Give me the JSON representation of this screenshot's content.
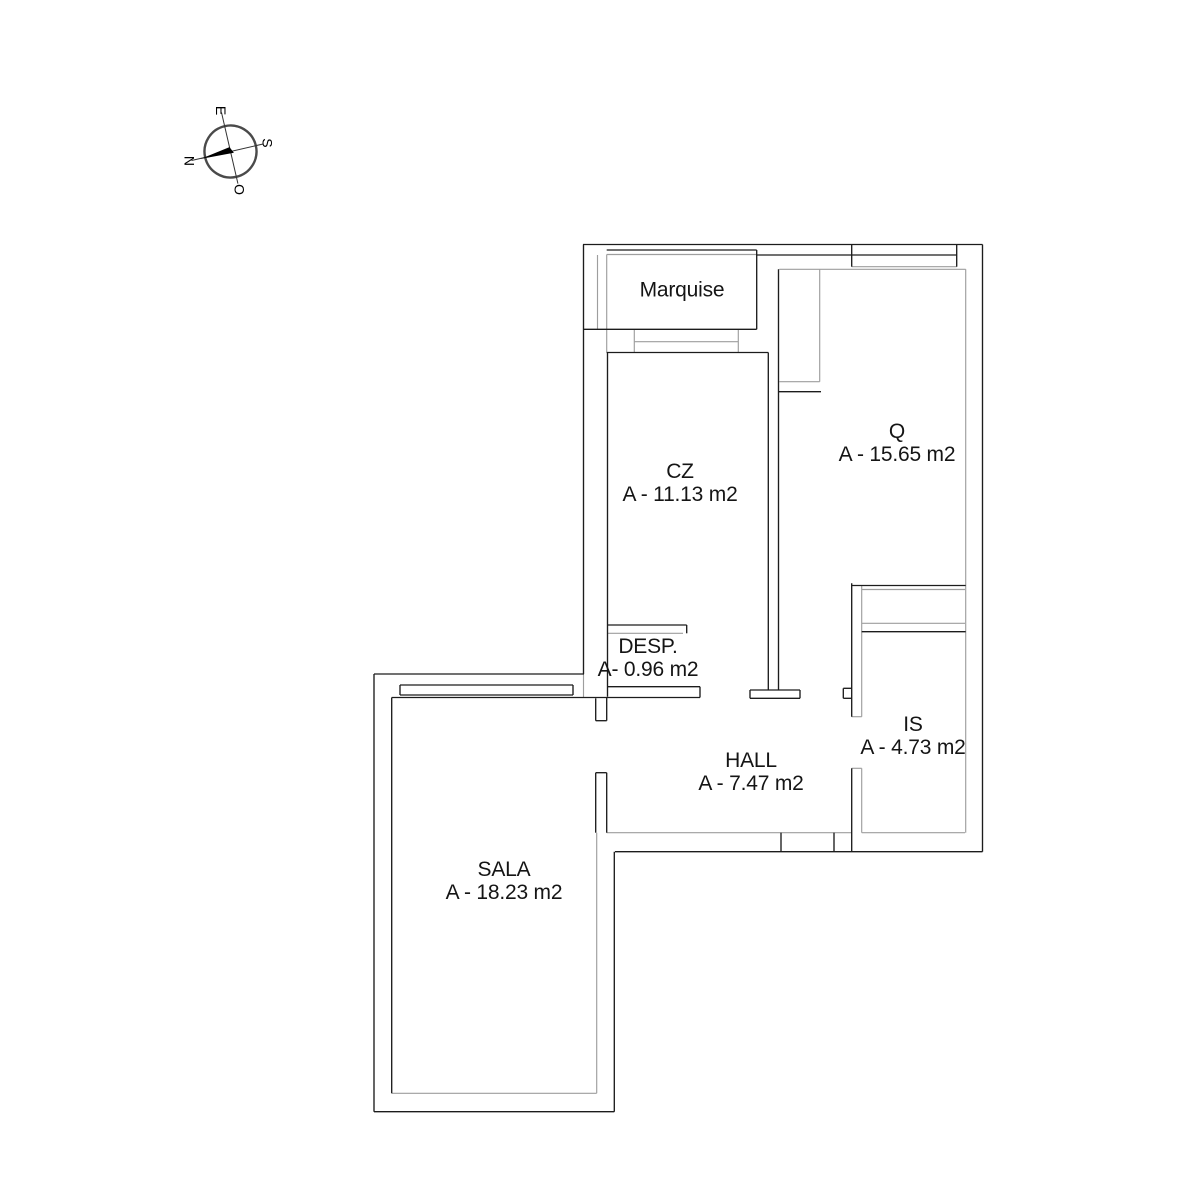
{
  "page": {
    "width": 1200,
    "height": 1200,
    "background": "#ffffff"
  },
  "colors": {
    "wall_dark": "#1c1c1c",
    "wall_light": "#9e9e9e",
    "text": "#151515",
    "compass_ring": "#4a4a4a",
    "compass_needle": "#000000"
  },
  "compass": {
    "center_x": 230.5,
    "center_y": 151.5,
    "radius": 26,
    "rotation_deg": -13,
    "letters": [
      {
        "text": "E",
        "dir": "up"
      },
      {
        "text": "S",
        "dir": "right"
      },
      {
        "text": "O",
        "dir": "down"
      },
      {
        "text": "N",
        "dir": "left"
      }
    ]
  },
  "rooms": [
    {
      "id": "marquise",
      "label": "Marquise",
      "area": "",
      "x": 682,
      "y": 290
    },
    {
      "id": "cz",
      "label": "CZ",
      "area": "A - 11.13 m2",
      "x": 680,
      "y": 483
    },
    {
      "id": "q",
      "label": "Q",
      "area": "A - 15.65 m2",
      "x": 897,
      "y": 443
    },
    {
      "id": "desp",
      "label": "DESP.",
      "area": "A- 0.96 m2",
      "x": 648,
      "y": 658
    },
    {
      "id": "is",
      "label": "IS",
      "area": "A - 4.73 m2",
      "x": 913,
      "y": 736
    },
    {
      "id": "hall",
      "label": "HALL",
      "area": "A - 7.47 m2",
      "x": 751,
      "y": 772
    },
    {
      "id": "sala",
      "label": "SALA",
      "area": "A - 18.23 m2",
      "x": 504,
      "y": 881
    }
  ],
  "walls": {
    "dark": [
      [
        583,
        244.5,
        982.5,
        244.5
      ],
      [
        982.5,
        244.5,
        982.5,
        851.7
      ],
      [
        615,
        851.7,
        982.5,
        851.7
      ],
      [
        583.5,
        244.5,
        583.5,
        674
      ],
      [
        606.7,
        250,
        756.7,
        250
      ],
      [
        756.7,
        250,
        756.7,
        329.3
      ],
      [
        583.5,
        329.3,
        756.7,
        329.3
      ],
      [
        756.7,
        255,
        851.7,
        255
      ],
      [
        851.7,
        244.5,
        851.7,
        266.7
      ],
      [
        956.7,
        244.5,
        956.7,
        266.7
      ],
      [
        851.7,
        255,
        956.7,
        255
      ],
      [
        768.3,
        352.5,
        768.3,
        690
      ],
      [
        778.5,
        269.3,
        778.5,
        690
      ],
      [
        750,
        690,
        800,
        690
      ],
      [
        750,
        698.3,
        800,
        698.3
      ],
      [
        750,
        690,
        750,
        698.3
      ],
      [
        800,
        690,
        800,
        698.3
      ],
      [
        606.7,
        352.5,
        768.3,
        352.5
      ],
      [
        607.5,
        352.5,
        607.5,
        696.7
      ],
      [
        608,
        625,
        686.7,
        625
      ],
      [
        686.7,
        625,
        686.7,
        633.3
      ],
      [
        608,
        686.7,
        700,
        686.7
      ],
      [
        391.7,
        697.5,
        700,
        697.5
      ],
      [
        700,
        686.7,
        700,
        697.5
      ],
      [
        778.5,
        391.7,
        821,
        391.7
      ],
      [
        851.7,
        585.5,
        965.7,
        585.5
      ],
      [
        851.7,
        583.3,
        851.7,
        716.7
      ],
      [
        861.7,
        631.7,
        965.7,
        631.7
      ],
      [
        843.3,
        688.3,
        851.7,
        688.3
      ],
      [
        843.3,
        698.3,
        851.7,
        698.3
      ],
      [
        843.3,
        688.3,
        843.3,
        698.3
      ],
      [
        851.7,
        768.3,
        851.7,
        851.7
      ],
      [
        781,
        832.7,
        781,
        851.7
      ],
      [
        834,
        832.7,
        834,
        851.7
      ],
      [
        595.7,
        698.3,
        595.7,
        720.7
      ],
      [
        606.7,
        697.5,
        606.7,
        720.7
      ],
      [
        595.7,
        720.7,
        606.7,
        720.7
      ],
      [
        595.7,
        772.7,
        595.7,
        832.7
      ],
      [
        606.7,
        772.7,
        606.7,
        832.7
      ],
      [
        595.7,
        772.7,
        606.7,
        772.7
      ],
      [
        374,
        674,
        584,
        674
      ],
      [
        374,
        674,
        374,
        1111.7
      ],
      [
        374,
        1111.7,
        614.3,
        1111.7
      ],
      [
        614.3,
        851.7,
        614.3,
        1111.7
      ],
      [
        400,
        685,
        573,
        685
      ],
      [
        400,
        695,
        573,
        695
      ],
      [
        400,
        685,
        400,
        695
      ],
      [
        573,
        685,
        573,
        695
      ],
      [
        391.7,
        697.5,
        391.7,
        1093.3
      ]
    ],
    "light": [
      [
        597.5,
        255,
        597.5,
        329.3
      ],
      [
        606.7,
        254.5,
        756.7,
        254.5
      ],
      [
        606.7,
        254.5,
        606.7,
        329.3
      ],
      [
        634.3,
        329.3,
        634.3,
        352.5
      ],
      [
        738.3,
        329.3,
        738.3,
        352.5
      ],
      [
        634.3,
        341.7,
        738.3,
        341.7
      ],
      [
        606.7,
        329.3,
        606.7,
        352.5
      ],
      [
        851.7,
        266.7,
        956.7,
        266.7
      ],
      [
        779.3,
        269.3,
        965.7,
        269.3
      ],
      [
        965.7,
        269.3,
        965.7,
        832.7
      ],
      [
        819.7,
        269.3,
        819.7,
        381.7
      ],
      [
        779.3,
        381.7,
        819.7,
        381.7
      ],
      [
        608,
        633.3,
        683,
        633.3
      ],
      [
        861.7,
        589.5,
        965,
        589.5
      ],
      [
        861.7,
        623.3,
        965,
        623.3
      ],
      [
        861.7,
        585.5,
        861.7,
        716.7
      ],
      [
        851.7,
        716.7,
        861.7,
        716.7
      ],
      [
        851.7,
        768.3,
        861.7,
        768.3
      ],
      [
        861.7,
        768.3,
        861.7,
        832.7
      ],
      [
        606.7,
        832.7,
        851.7,
        832.7
      ],
      [
        861.7,
        832.7,
        965,
        832.7
      ],
      [
        583.5,
        674,
        583.5,
        697.5
      ],
      [
        391.7,
        1093.3,
        596.7,
        1093.3
      ],
      [
        596.7,
        832.7,
        596.7,
        1093.3
      ]
    ]
  }
}
